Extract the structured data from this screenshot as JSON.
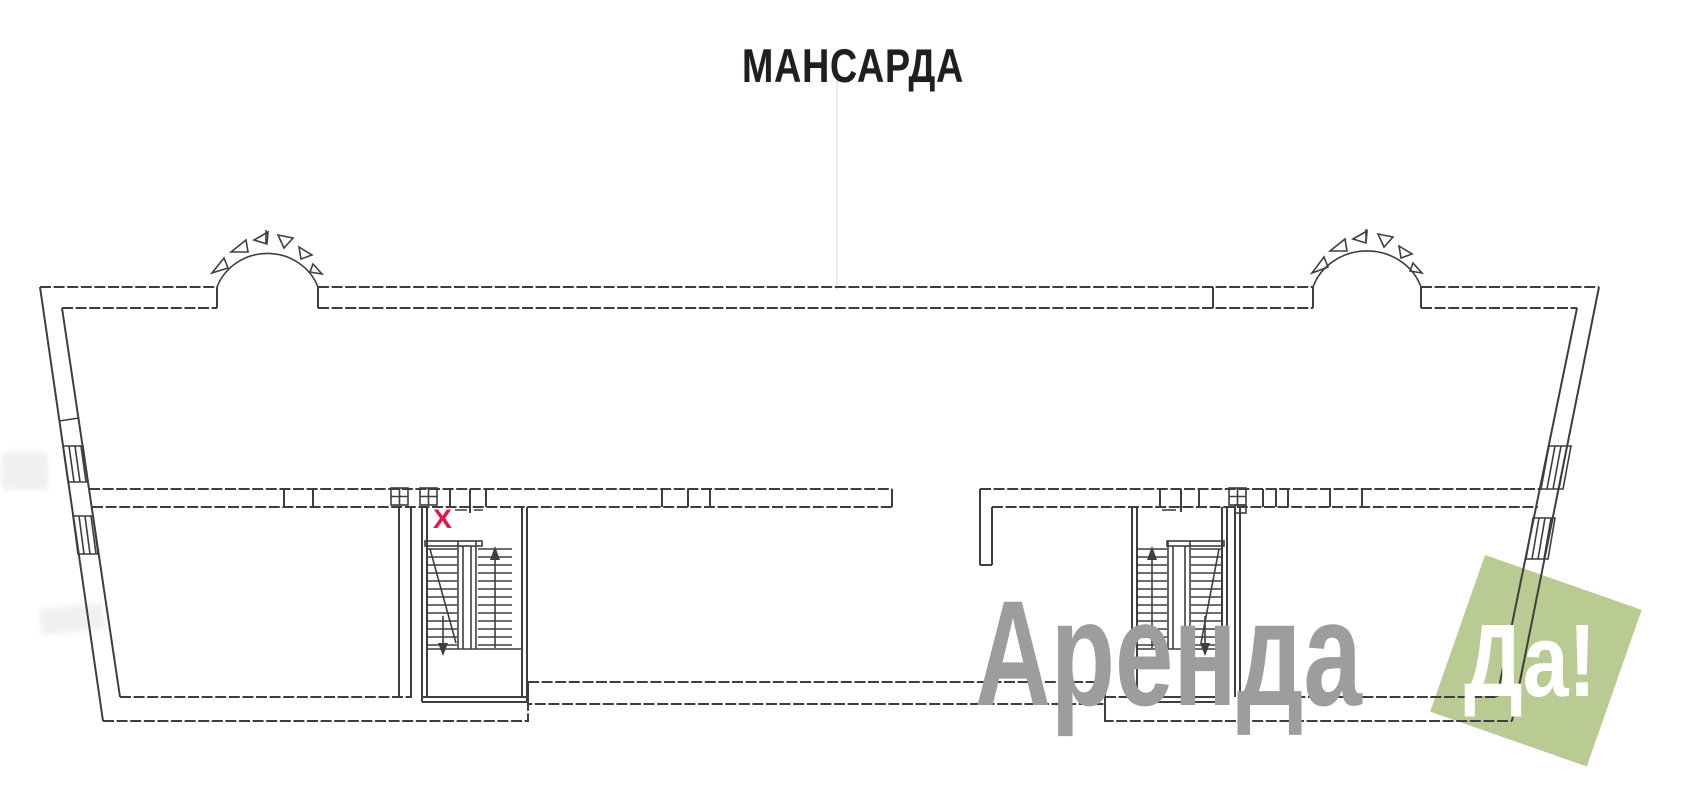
{
  "title": "МАНСАРДА",
  "plan": {
    "marker": "X",
    "marker_color": "#e4164a",
    "line_color": "#3e3e3e",
    "background_color": "#ffffff"
  },
  "watermark": {
    "brand": "Аренда",
    "badge": "Да!",
    "brand_color": "#9d9d9d",
    "badge_bg": "#b9ca93",
    "badge_text_color": "#ffffff"
  }
}
